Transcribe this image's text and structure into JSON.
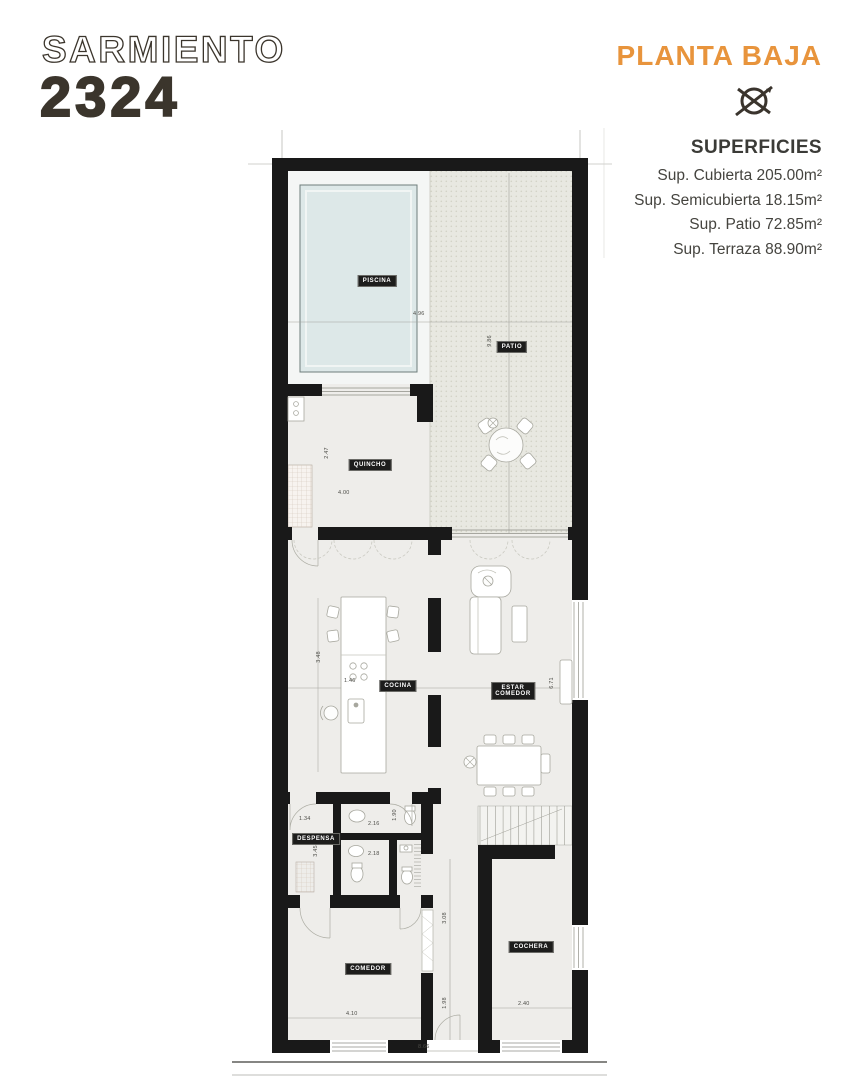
{
  "header": {
    "street_name": "SARMIENTO",
    "street_number": "2324",
    "plan_title": "PLANTA BAJA"
  },
  "superficies": {
    "title": "SUPERFICIES",
    "items": [
      {
        "label": "Sup. Cubierta",
        "value": "205.00m²"
      },
      {
        "label": "Sup. Semicubierta",
        "value": "18.15m²"
      },
      {
        "label": "Sup. Patio",
        "value": "72.85m²"
      },
      {
        "label": "Sup. Terraza",
        "value": "88.90m²"
      }
    ]
  },
  "floor_plan": {
    "rooms": {
      "piscina": "PISCINA",
      "patio": "PATIO",
      "quincho": "QUINCHO",
      "cocina": "COCINA",
      "estar_line1": "ESTAR",
      "estar_line2": "COMEDOR",
      "despensa": "DESPENSA",
      "comedor": "COMEDOR",
      "cochera": "COCHERA"
    },
    "dimensions": [
      {
        "text": "4.96"
      },
      {
        "text": "9.86"
      },
      {
        "text": "2.47"
      },
      {
        "text": "4.00"
      },
      {
        "text": "3.48"
      },
      {
        "text": "1.46"
      },
      {
        "text": "6.71"
      },
      {
        "text": "1.34"
      },
      {
        "text": "3.45"
      },
      {
        "text": "1.90"
      },
      {
        "text": "2.16"
      },
      {
        "text": "2.18"
      },
      {
        "text": "3.08"
      },
      {
        "text": "1.98"
      },
      {
        "text": "4.10"
      },
      {
        "text": "2.40"
      },
      {
        "text": "8.66"
      }
    ]
  },
  "colors": {
    "accent_orange": "#E8943C",
    "title_brown": "#3B352C",
    "wall_black": "#191919",
    "pool_water": "#DDE8E8",
    "patio_gray": "#E8E8E1"
  }
}
